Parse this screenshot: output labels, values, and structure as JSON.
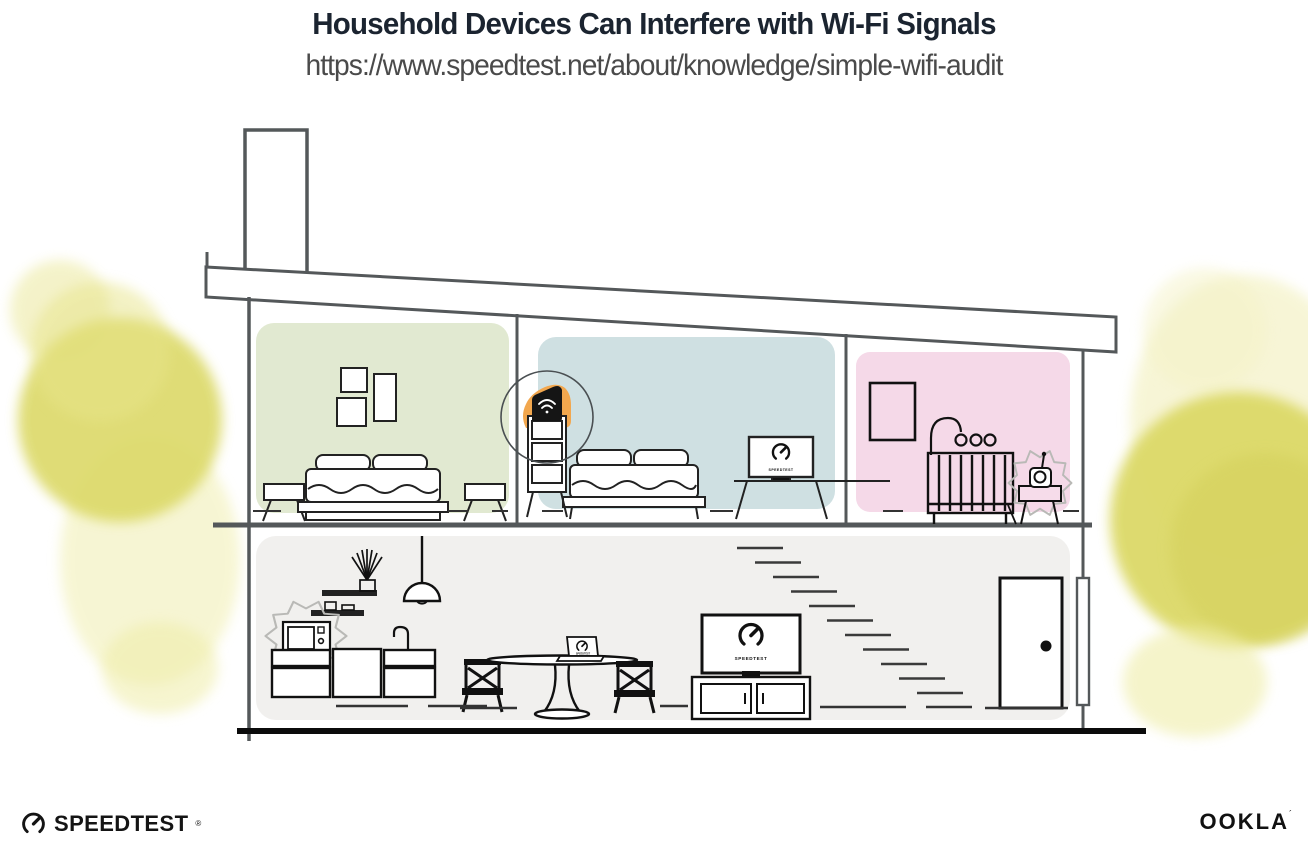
{
  "header": {
    "title": "Household Devices Can Interfere with Wi-Fi Signals",
    "url": "https://www.speedtest.net/about/knowledge/simple-wifi-audit"
  },
  "branding": {
    "speedtest": "SPEEDTEST",
    "speedtest_mark": "®",
    "ookla": "OOKLA",
    "ookla_mark": "´",
    "screen_label": "SPEEDTEST"
  },
  "illustration": {
    "icons": {
      "router": "wifi-icon",
      "tv_screens": "speedtest-gauge-icon",
      "logo": "speedtest-gauge-icon"
    },
    "colors": {
      "accent_orange": "#F2A74E",
      "room_green": "#E1E9D1",
      "room_blue": "#CFE0E2",
      "room_pink": "#F5D9E8",
      "ground_floor": "#F1F0EE",
      "tree_yellow": "#DCD968",
      "structure_line": "#54585A",
      "ink": "#111111",
      "title_text": "#1B2430",
      "url_text": "#4A4A4A"
    }
  }
}
